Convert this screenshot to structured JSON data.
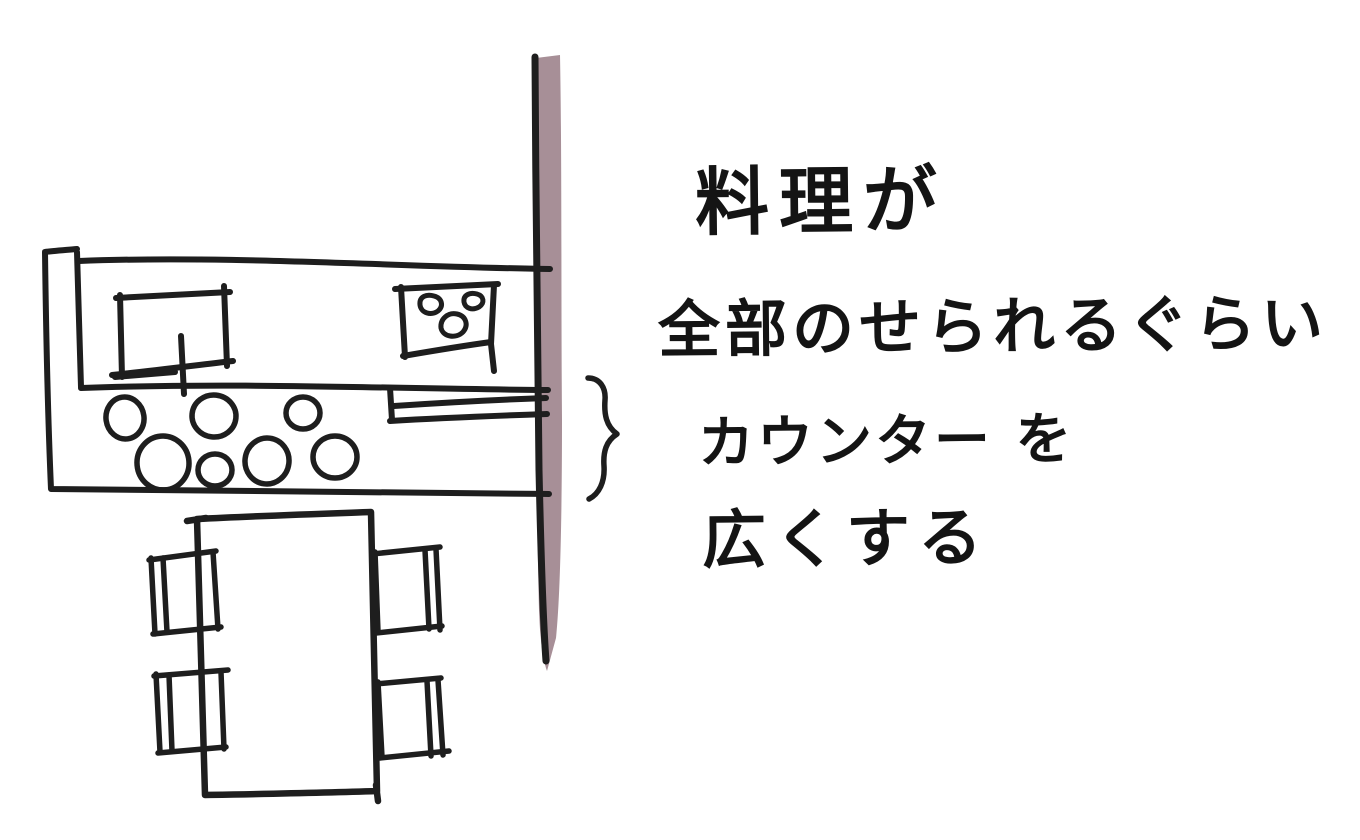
{
  "annotation": {
    "lines": [
      "料理が",
      "全部のせられるぐらい",
      "カウンター を",
      "広くする"
    ],
    "full_text": "料理が全部のせられるぐらいカウンターを広くする"
  },
  "colors": {
    "ink": "#1e1e1e",
    "wall_fill": "#a78f97",
    "background": "#ffffff",
    "text_ink": "#141414"
  },
  "sketch": {
    "figures": [
      "kitchen-counter",
      "sink",
      "faucet",
      "stove-with-three-burners",
      "dishes-on-counter",
      "serving-bar",
      "wall-strip",
      "curly-brace-mark",
      "dining-table",
      "four-chairs"
    ]
  }
}
